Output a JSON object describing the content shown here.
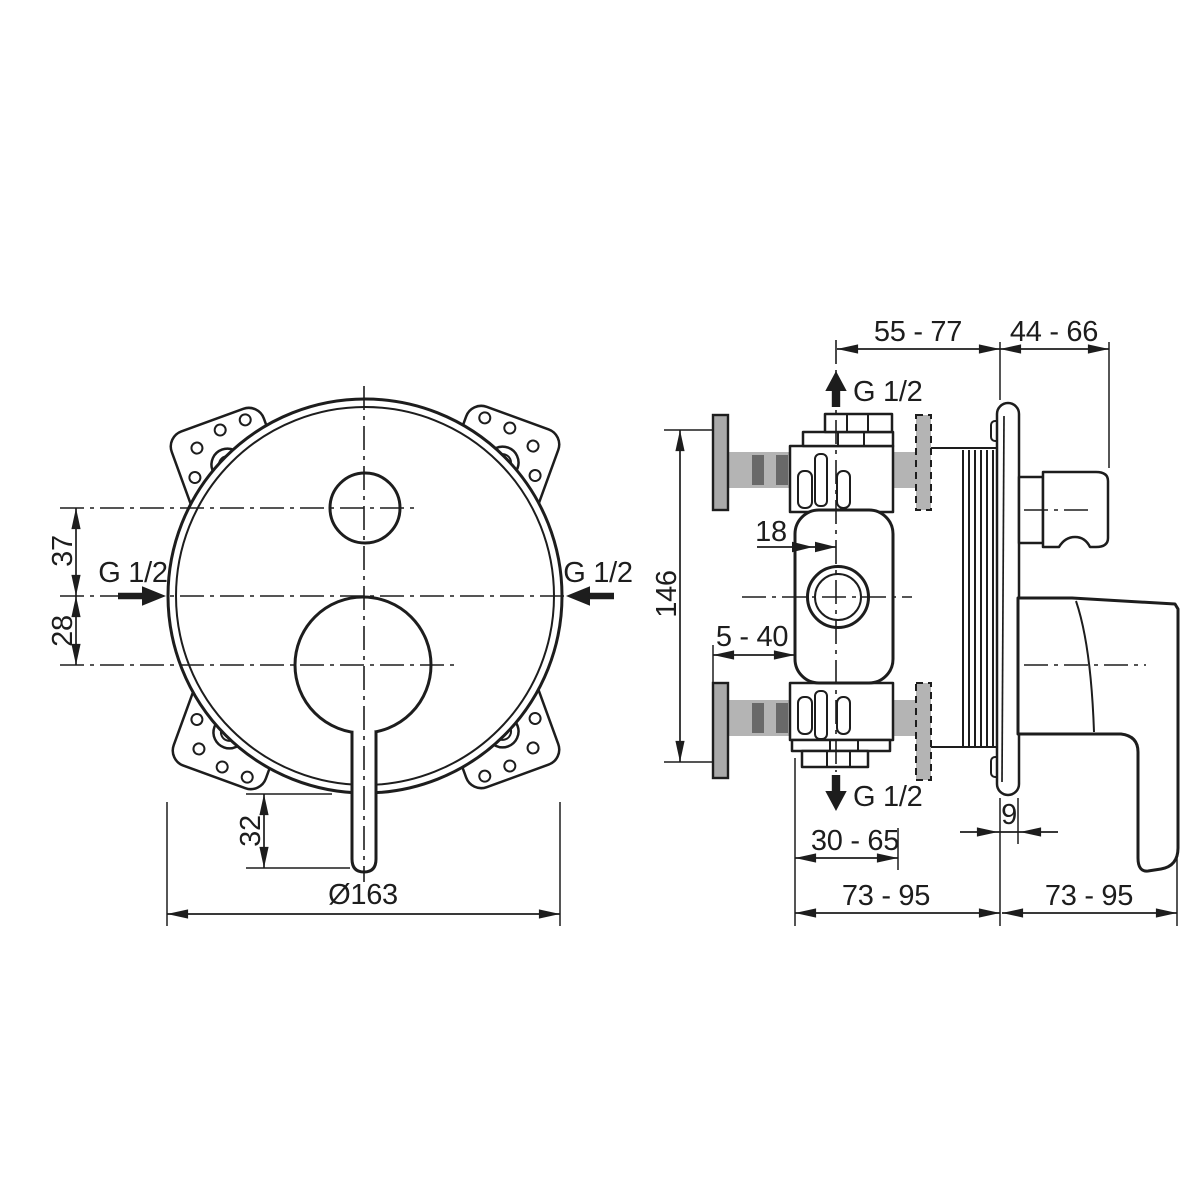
{
  "colors": {
    "background": "#ffffff",
    "line": "#1d1d1d",
    "pipe": "#b4b4b4",
    "tick": "#696969",
    "flange": "#a9a9a9"
  },
  "front_view": {
    "labels": {
      "offset_top": "37",
      "offset_bottom": "28",
      "inlet_left": "G 1/2",
      "inlet_right": "G 1/2",
      "lever_length": "32",
      "plate_diameter": "Ø163"
    }
  },
  "side_view": {
    "labels": {
      "depth_to_wall": "55 - 77",
      "projection": "44 - 66",
      "outlet_top": "G 1/2",
      "center_offset": "18",
      "body_height": "146",
      "depth_adjust": "5 - 40",
      "outlet_bottom": "G 1/2",
      "depth_body": "30 - 65",
      "plate_thickness": "9",
      "depth_rear": "73 - 95",
      "projection_total": "73 - 95"
    }
  }
}
